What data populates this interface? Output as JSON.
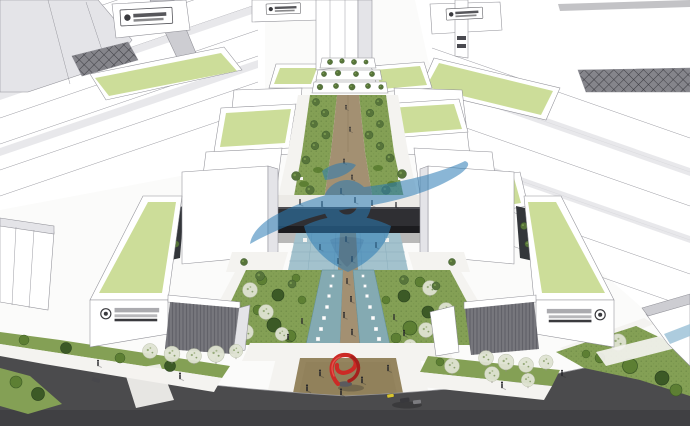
{
  "scene": {
    "kind": "aerial 3D massing rendering of a campus with a central landscaped pedestrian axis",
    "watermark": {
      "shape": "swoosh, ring and location pin",
      "color": "#2b7cb5"
    },
    "signs": {
      "rooftop_sign_count": 3,
      "facade_sign_count": 2,
      "text_legible": false
    },
    "vehicles_on_road": 4
  },
  "colors": {
    "paper": "#fbfbfa",
    "white_face": "#ffffff",
    "shade_face": "#e4e4e8",
    "shade_dark": "#cdcdd2",
    "edge": "#8f8f96",
    "green_roof": "#ccdd99",
    "lawn": "#84a055",
    "shrub": "#5d7f33",
    "shrub_dark": "#3c5a26",
    "tree_green": "#57743a",
    "tree_pale": "#dfe3d2",
    "water": "#84aab2",
    "paving_blue": "#a3c2cd",
    "path_tan": "#a39072",
    "plaza_tan": "#95855f",
    "road": "#4b4b4d",
    "road_dark": "#3c3c3e",
    "bridge": "#2f2f33",
    "louver": "#77777d",
    "sidewalk": "#f4f3f0",
    "sculpture_red": "#cc2a26",
    "watermark_blue": "#2b7cb5",
    "watermark_dark": "#155f9e",
    "sign_dark": "#3a3a3e",
    "glass_blue": "#9fc3d8",
    "car_yellow": "#d8c52e"
  }
}
